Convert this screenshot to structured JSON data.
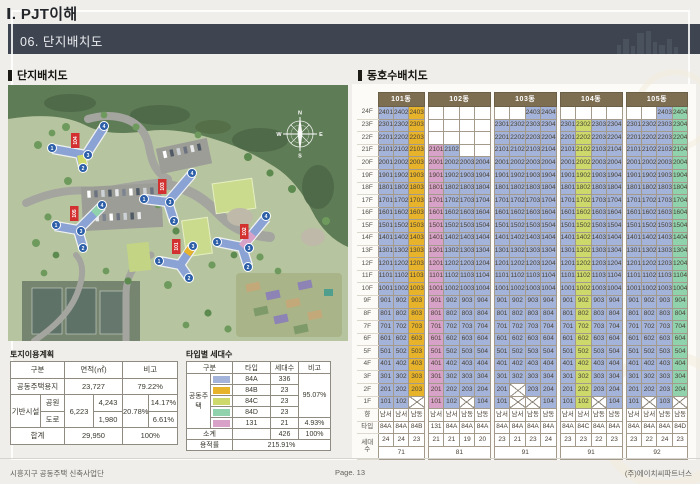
{
  "page": {
    "title": "Ⅰ. PJT이해",
    "section": "06. 단지배치도"
  },
  "footer": {
    "left": "시흥지구 공동주택 신축사업단",
    "center": "Page. 13",
    "right": "(주)에이치씨파트너스"
  },
  "left_panel": {
    "title": "단지배치도",
    "site_plan": {
      "compass": {
        "n": "N",
        "e": "E",
        "s": "S",
        "w": "W"
      },
      "tags": [
        "101",
        "102",
        "103",
        "104",
        "105"
      ],
      "markers": [
        "1",
        "2",
        "3",
        "4"
      ]
    },
    "land_table": {
      "title": "토지이용계획",
      "headers": {
        "gubun": "구분",
        "area": "면적(㎡)",
        "note": "비고"
      },
      "rows": {
        "housing_label": "공동주택용지",
        "housing_area": "23,727",
        "housing_note": "79.22%",
        "infra_label": "기반시설",
        "infra_area_total": "6,223",
        "infra_note_total": "20.78%",
        "park_label": "공원",
        "park_area": "4,243",
        "park_note": "14.17%",
        "road_label": "도로",
        "road_area": "1,980",
        "road_note": "6.61%",
        "total_label": "합계",
        "total_area": "29,950",
        "total_note": "100%"
      }
    },
    "type_table": {
      "title": "타입별 세대수",
      "headers": {
        "gubun": "구분",
        "type": "타입",
        "count": "세대수",
        "note": "비고"
      },
      "group_label": "공동주택",
      "rows": [
        {
          "type": "84A",
          "count": "336",
          "color": "#a3b3d9"
        },
        {
          "type": "84B",
          "count": "23",
          "color": "#e7b32a"
        },
        {
          "type": "84C",
          "count": "23",
          "color": "#cdda6b"
        },
        {
          "type": "84D",
          "count": "23",
          "color": "#8fd2ac"
        },
        {
          "type": "131",
          "count": "21",
          "color": "#d8a2c8"
        }
      ],
      "note_main": "95.07%",
      "note_131": "4.93%",
      "subtotal_label": "소계",
      "subtotal_count": "426",
      "subtotal_note": "100%",
      "far_label": "용적률",
      "far_value": "215.91%"
    }
  },
  "right_panel": {
    "title": "동호수배치도",
    "unit_table": {
      "floors_top": 24,
      "side_labels": {
        "direction": "향",
        "type": "타입",
        "count_top": "세대",
        "count_bottom": "수"
      },
      "type_colors": {
        "84A": "#a3b3d9",
        "84B": "#e7b32a",
        "84C": "#cdda6b",
        "84D": "#8fd2ac",
        "131": "#d8a2c8"
      },
      "buildings": [
        {
          "name": "101동",
          "total": "71",
          "columns": [
            {
              "pos": 1,
              "top": 24,
              "crossed": [],
              "type": "84A",
              "dir": "남서",
              "count": "24"
            },
            {
              "pos": 2,
              "top": 24,
              "crossed": [],
              "type": "84A",
              "dir": "남서",
              "count": "24"
            },
            {
              "pos": 3,
              "top": 24,
              "crossed": [
                1
              ],
              "type": "84B",
              "dir": "남동",
              "count": "23"
            }
          ]
        },
        {
          "name": "102동",
          "total": "81",
          "columns": [
            {
              "pos": 1,
              "top": 21,
              "crossed": [],
              "type": "131",
              "dir": "남서",
              "count": "21"
            },
            {
              "pos": 2,
              "top": 21,
              "crossed": [],
              "type": "84A",
              "dir": "남서",
              "count": "21"
            },
            {
              "pos": 3,
              "top": 20,
              "crossed": [
                1
              ],
              "type": "84A",
              "dir": "남동",
              "count": "19"
            },
            {
              "pos": 4,
              "top": 20,
              "crossed": [],
              "type": "84A",
              "dir": "남동",
              "count": "20"
            }
          ]
        },
        {
          "name": "103동",
          "total": "91",
          "columns": [
            {
              "pos": 1,
              "top": 23,
              "crossed": [],
              "type": "84A",
              "dir": "남서",
              "count": "23"
            },
            {
              "pos": 2,
              "top": 23,
              "crossed": [
                1,
                2
              ],
              "type": "84A",
              "dir": "남서",
              "count": "21"
            },
            {
              "pos": 3,
              "top": 24,
              "crossed": [
                1
              ],
              "type": "84A",
              "dir": "남동",
              "count": "23"
            },
            {
              "pos": 4,
              "top": 24,
              "crossed": [],
              "type": "84A",
              "dir": "남동",
              "count": "24"
            }
          ]
        },
        {
          "name": "104동",
          "total": "91",
          "columns": [
            {
              "pos": 1,
              "top": 23,
              "crossed": [],
              "type": "84A",
              "dir": "남서",
              "count": "23"
            },
            {
              "pos": 2,
              "top": 23,
              "crossed": [],
              "type": "84C",
              "dir": "남서",
              "count": "23"
            },
            {
              "pos": 3,
              "top": 23,
              "crossed": [
                1
              ],
              "type": "84A",
              "dir": "남동",
              "count": "22"
            },
            {
              "pos": 4,
              "top": 23,
              "crossed": [],
              "type": "84A",
              "dir": "남동",
              "count": "23"
            }
          ]
        },
        {
          "name": "105동",
          "total": "92",
          "columns": [
            {
              "pos": 1,
              "top": 23,
              "crossed": [],
              "type": "84A",
              "dir": "남서",
              "count": "23"
            },
            {
              "pos": 2,
              "top": 23,
              "crossed": [
                1
              ],
              "type": "84A",
              "dir": "남서",
              "count": "22"
            },
            {
              "pos": 3,
              "top": 24,
              "crossed": [],
              "type": "84A",
              "dir": "남동",
              "count": "24"
            },
            {
              "pos": 4,
              "top": 24,
              "crossed": [
                1
              ],
              "type": "84D",
              "dir": "남동",
              "count": "23"
            }
          ]
        }
      ]
    }
  }
}
